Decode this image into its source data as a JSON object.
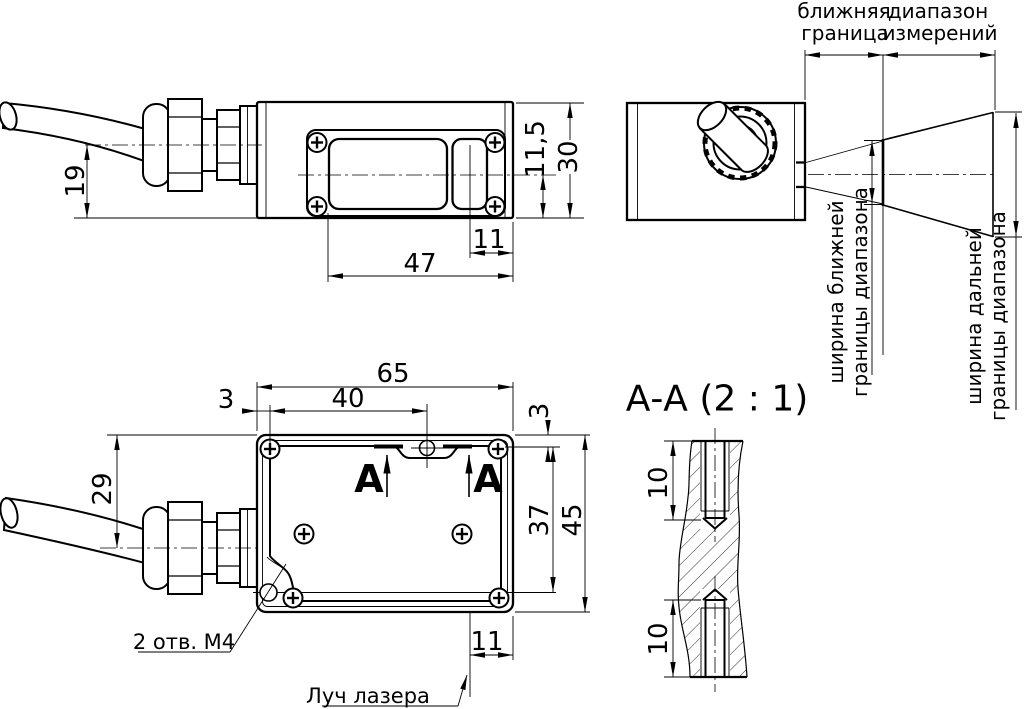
{
  "side_view": {
    "dim_cable_center": "19",
    "dim_window_center": "11,5",
    "dim_height": "30",
    "dim_window_offset": "11",
    "dim_window_span": "47"
  },
  "end_view": {
    "near_1": "ближняя",
    "near_2": "граница",
    "range_1": "диапазон",
    "range_2": "измерений",
    "near_width_1": "ширина ближней",
    "near_width_2": "границы диапазона",
    "far_width_1": "ширина дальней",
    "far_width_2": "границы диапазона"
  },
  "top_view": {
    "dim_width": "65",
    "dim_hole_offset": "40",
    "dim_edge_left": "3",
    "dim_cable_offset": "29",
    "dim_edge_top": "3",
    "dim_hole_depth": "37",
    "dim_height": "45",
    "dim_beam_offset": "11",
    "section_letter_left": "А",
    "section_letter_right": "А",
    "holes_note": "2 отв. М4",
    "laser_note": "Луч лазера"
  },
  "section_view": {
    "title": "А-А (2 : 1)",
    "dim_thread_top": "10",
    "dim_thread_bottom": "10"
  }
}
